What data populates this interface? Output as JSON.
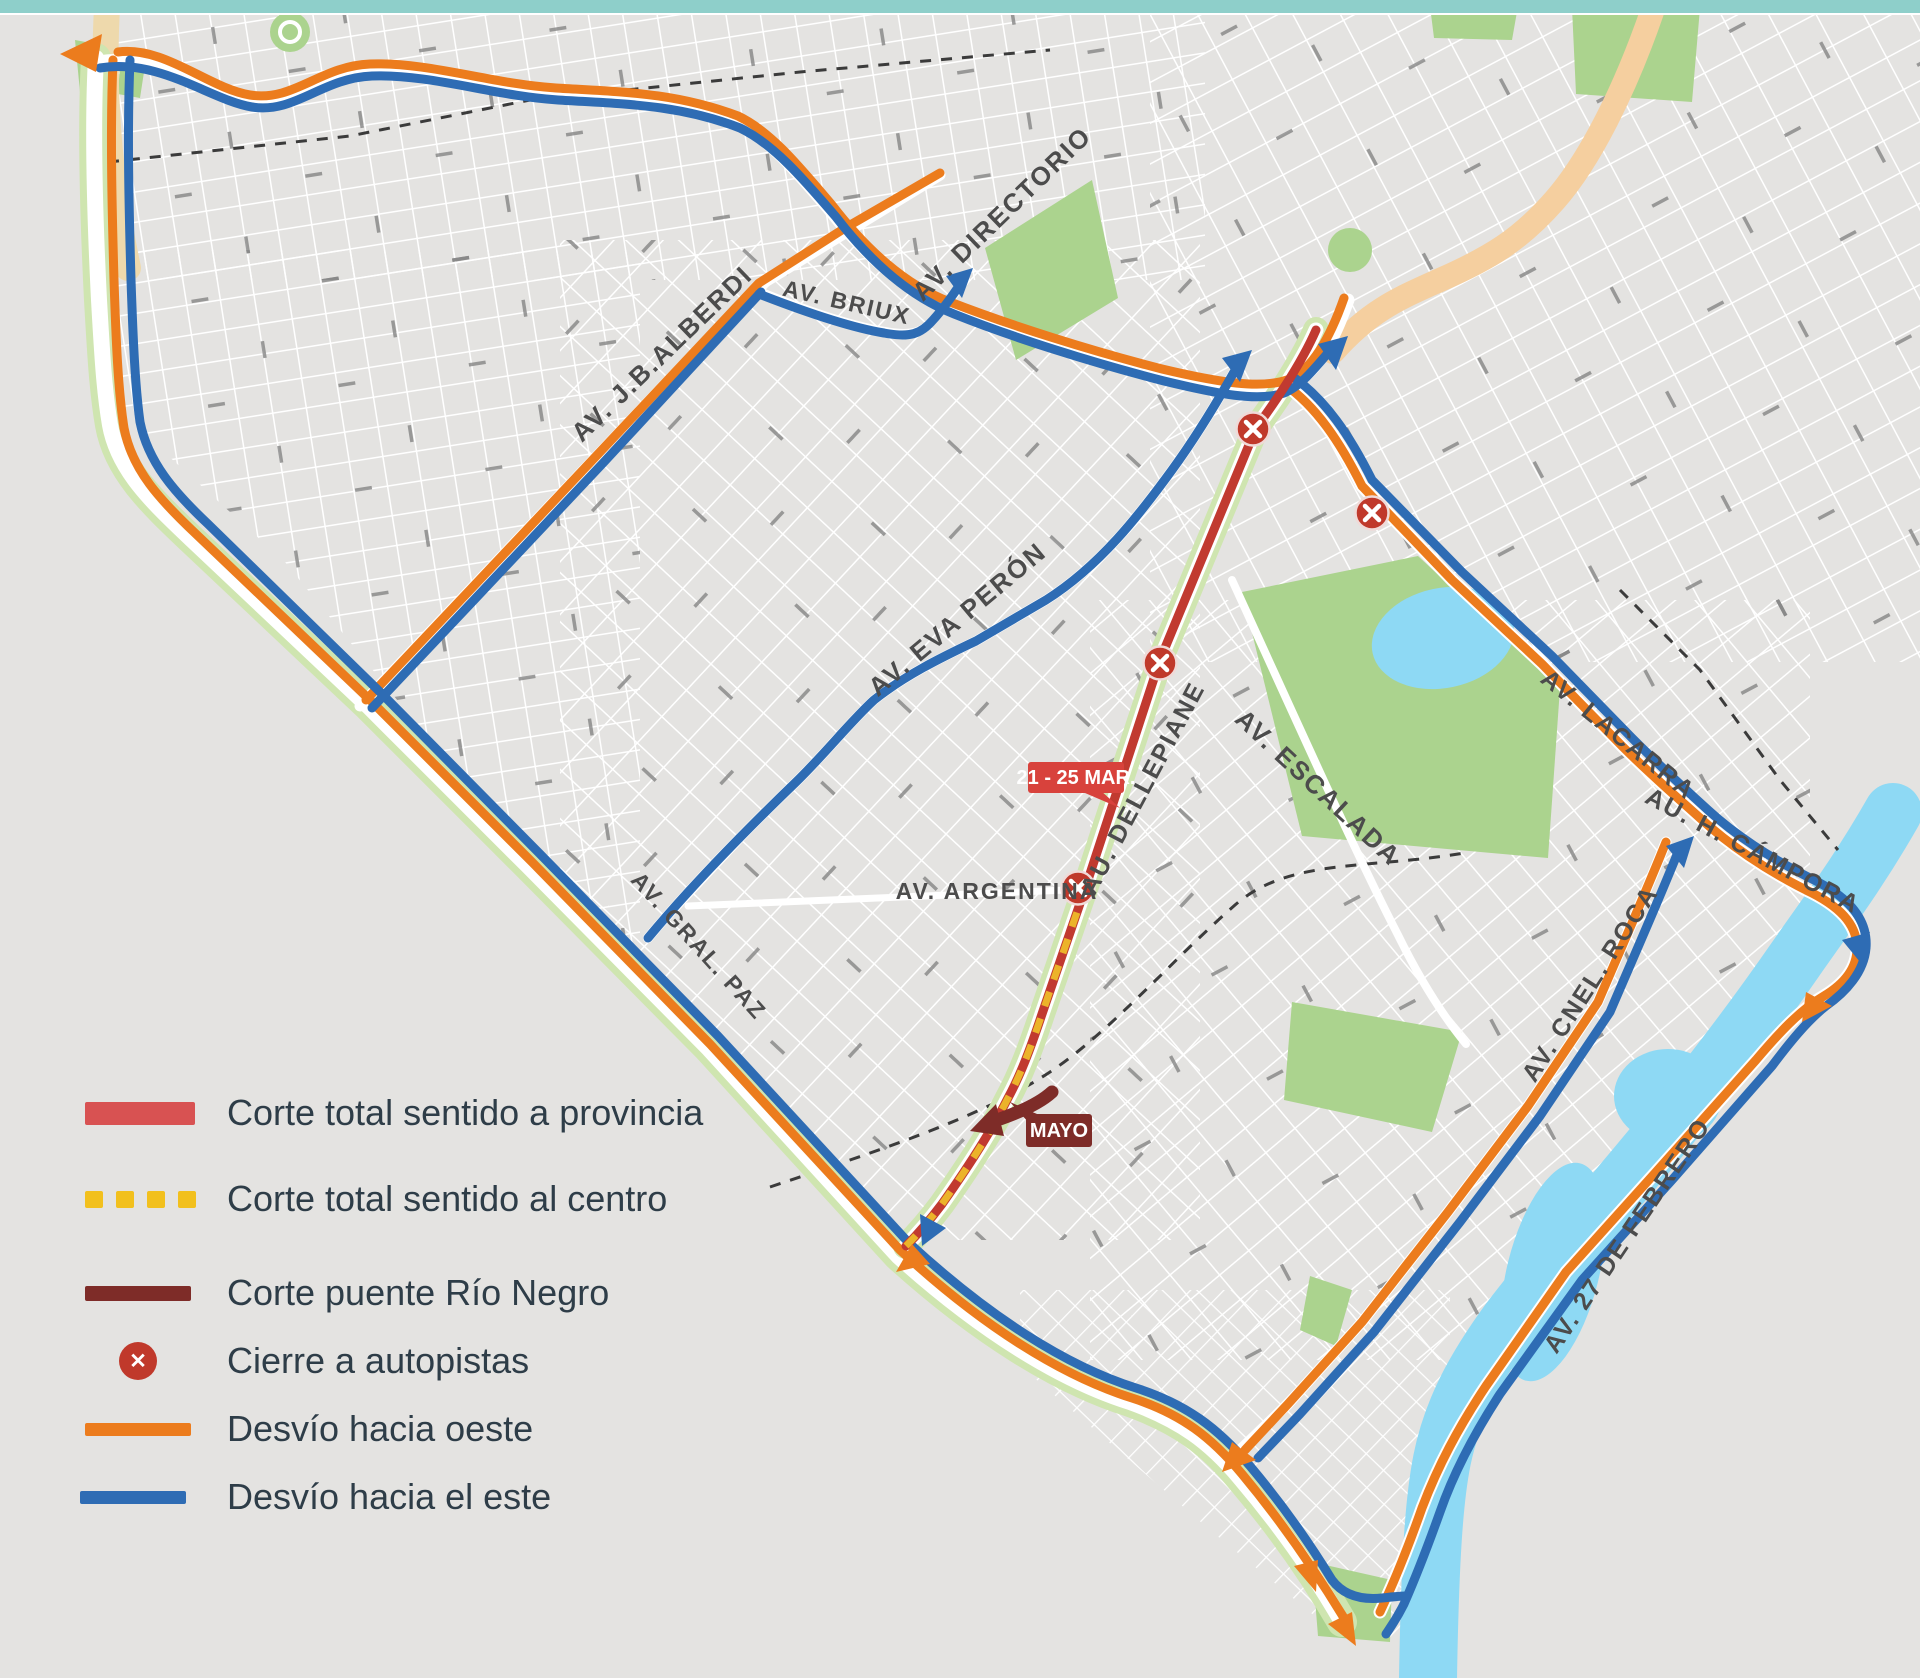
{
  "legend": {
    "items": [
      {
        "label": "Corte total sentido a provincia",
        "swatch": "solid-bar",
        "color": "#d85252"
      },
      {
        "label": "Corte total sentido al centro",
        "swatch": "dashed-bar",
        "color": "#f2c01d"
      },
      {
        "label": "Corte puente Río Negro",
        "swatch": "solid-bar",
        "color": "#7e2c28"
      },
      {
        "label": "Cierre a autopistas",
        "swatch": "x-circle-icon",
        "color": "#c0392b"
      },
      {
        "label": "Desvío hacia oeste",
        "swatch": "solid-bar",
        "color": "#ec7c1d"
      },
      {
        "label": "Desvío hacia el este",
        "swatch": "solid-bar",
        "color": "#2e6cb4"
      }
    ]
  },
  "badges": {
    "date_range": "21 - 25 MAR.",
    "bridge_label": "MAYO"
  },
  "streets": [
    {
      "name": "AV. J.B.ALBERDI"
    },
    {
      "name": "AV. BRIUX"
    },
    {
      "name": "AV. DIRECTORIO"
    },
    {
      "name": "AV. EVA PERÓN"
    },
    {
      "name": "AU. DELLEPIANE"
    },
    {
      "name": "AV. ESCALADA"
    },
    {
      "name": "AV. ARGENTINA"
    },
    {
      "name": "AV. GRAL. PAZ"
    },
    {
      "name": "AV. LACARRA"
    },
    {
      "name": "AU. H. CÁMPORA"
    },
    {
      "name": "AV. CNEL. ROCA"
    },
    {
      "name": "AV. 27 DE FEBRERO"
    }
  ],
  "colors": {
    "top_bar": "#8ecfca",
    "map_background": "#e4e3e1",
    "closure_to_province": "#c13a30",
    "closure_to_center": "#ecb32a",
    "bridge_closure": "#7e2c28",
    "detour_west": "#ec7c1d",
    "detour_east": "#2e6cb4",
    "closure_marker": "#c0392b",
    "park": "#abd38e",
    "water": "#8ed9f4"
  }
}
